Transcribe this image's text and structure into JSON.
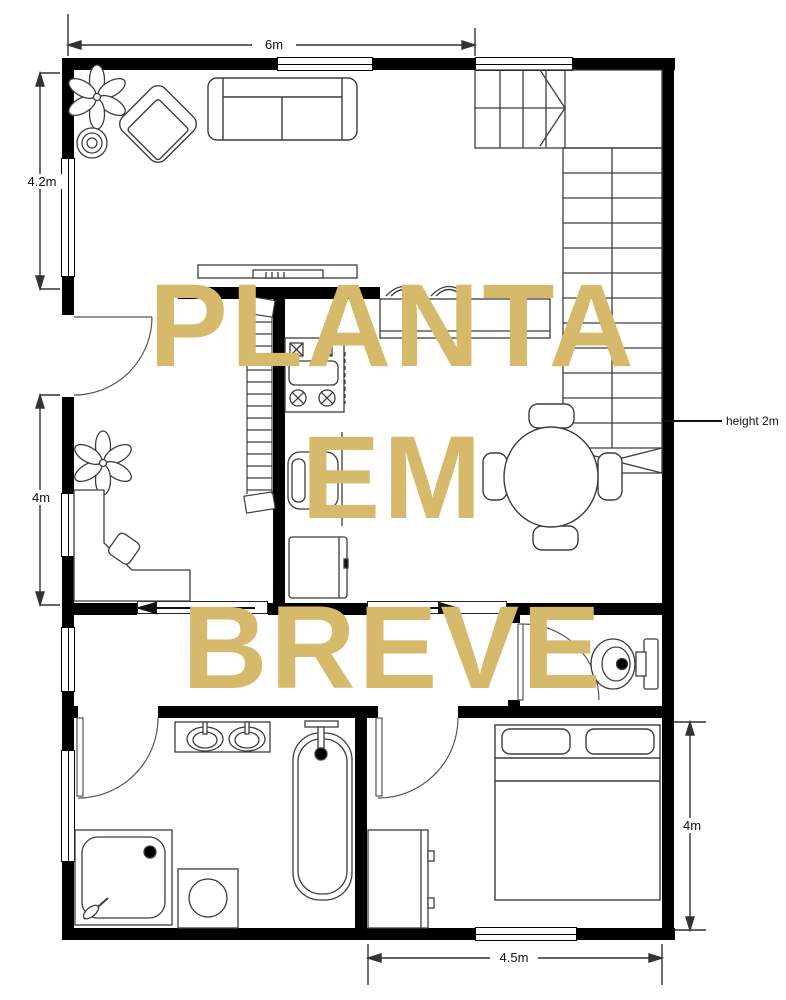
{
  "watermark": {
    "lines": [
      "PLANTA",
      "EM",
      "BREVE"
    ],
    "color": "#D6B96B"
  },
  "dimensions": {
    "top_width": "6m",
    "left_upper_height": "4.2m",
    "left_lower_height": "4m",
    "right_height": "4m",
    "bottom_width": "4.5m",
    "stairs_height_note": "height 2m"
  },
  "colors": {
    "walls": "#000000",
    "furniture_outline": "#3d3d3d",
    "background": "#ffffff",
    "watermark": "#D6B96B"
  }
}
